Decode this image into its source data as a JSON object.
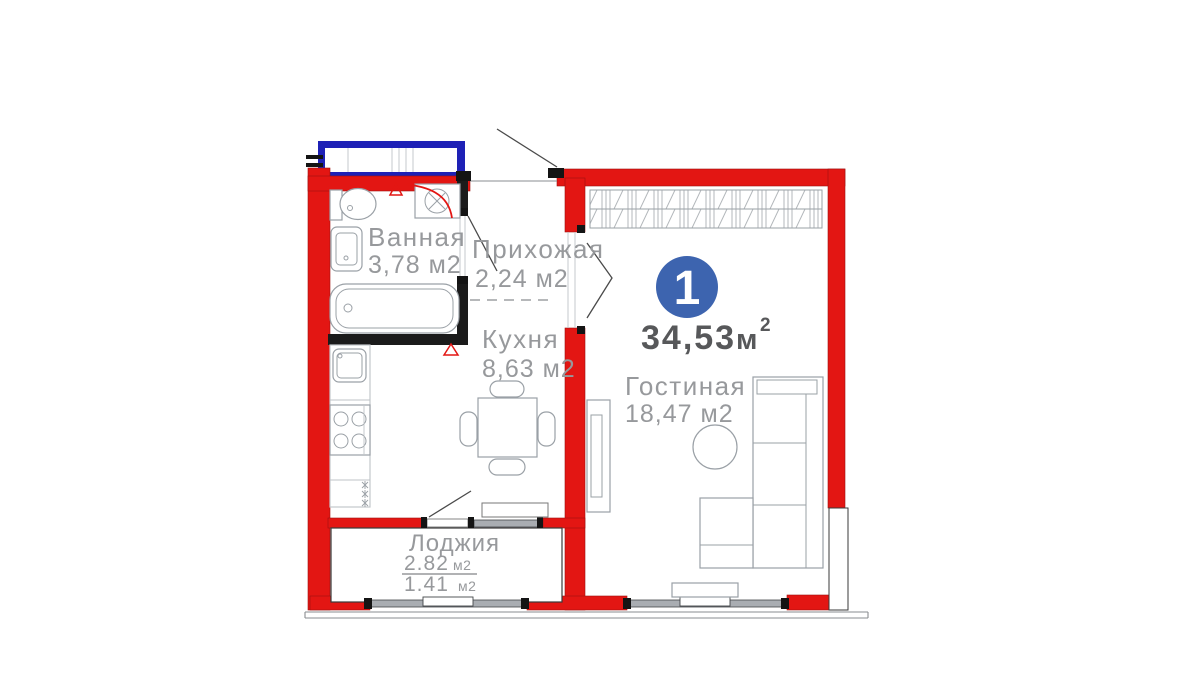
{
  "meta": {
    "type": "apartment-floor-plan",
    "language": "ru"
  },
  "summary": {
    "rooms_badge": "1",
    "total_area_value": "34,53",
    "total_area_unit": "м",
    "total_area_sup": "2"
  },
  "rooms": {
    "bathroom": {
      "name": "Ванная",
      "area": "3,78 м2"
    },
    "hallway": {
      "name": "Прихожая",
      "area": "2,24 м2"
    },
    "kitchen": {
      "name": "Кухня",
      "area": "8,63 м2"
    },
    "living": {
      "name": "Гостиная",
      "area": "18,47 м2"
    },
    "loggia": {
      "name": "Лоджия",
      "area_full": "2.82",
      "area_full_unit": "м2",
      "area_reduced": "1.41",
      "area_reduced_unit": "м2"
    }
  },
  "colors": {
    "wall": "#e31613",
    "inner_wall": "#1b1b1b",
    "window_blue": "#1e21b6",
    "badge": "#3d64af",
    "label": "#97999c",
    "total_text": "#57585a",
    "furniture": "#9aa0a6",
    "glass": "#a9adb2"
  }
}
